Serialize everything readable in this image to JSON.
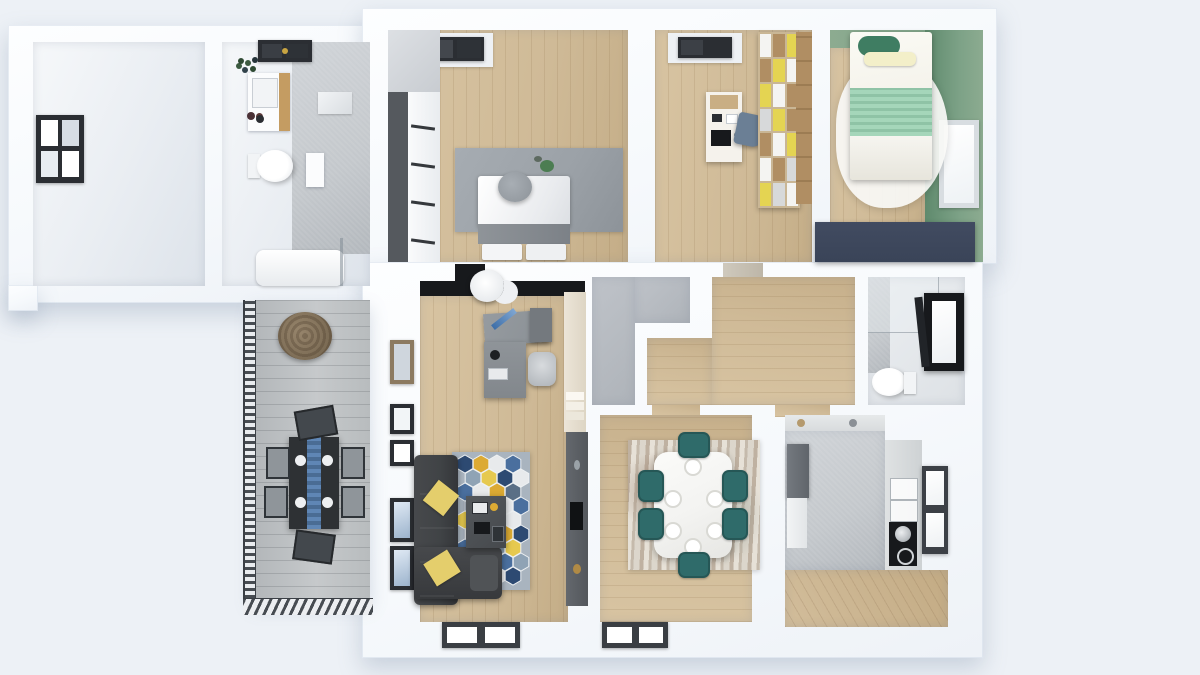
{
  "scene": {
    "name": "apartment-3d-floor-plan-top-view",
    "style": "3d-architectural-render",
    "visible_text": []
  },
  "colors": {
    "bg": "#edf1f6",
    "wood": "#cfba97",
    "wood_line": "rgba(125,95,55,.14)",
    "tile": "#c4c8cc",
    "closet": "#aeb3b9",
    "green_wall": "#7da287",
    "green_deep": "#5f8a6d",
    "mint": "#a5d6ba",
    "navy": "#3a4458",
    "sofa": "#404346",
    "pillow": "#e4ce6c",
    "teal": "#2f6b6a",
    "marble": "#f3f3f1",
    "rug_gray": "#9ba1a7",
    "desk": "#8a9095",
    "black": "#17191c",
    "cream": "#ece5d8",
    "frame": "#2b2e33",
    "hex_navy": "#2d4a72",
    "hex_blue": "#4a6f9e",
    "hex_yellow": "#dcaa33",
    "hex_light": "#e8eaec",
    "cube_yellow": "#e4d452",
    "cube_wood": "#b08e63"
  },
  "rooms": [
    {
      "id": "empty-room",
      "floor": "white",
      "furniture": [
        "left-wall-window"
      ]
    },
    {
      "id": "bathroom-main",
      "floor": "gray-tile",
      "furniture": [
        "skylight-window",
        "plant",
        "wood-vanity",
        "toilet",
        "wall-niche",
        "bathtub",
        "shower-glass"
      ]
    },
    {
      "id": "bedroom-1",
      "floor": "wood",
      "furniture": [
        "skylight-window",
        "wardrobe",
        "gray-rug",
        "double-bed",
        "round-pouf"
      ]
    },
    {
      "id": "study",
      "floor": "wood",
      "furniture": [
        "skylight-window",
        "desk",
        "desk-chair",
        "cube-shelf"
      ]
    },
    {
      "id": "bedroom-2-green",
      "floor": "wood",
      "wall_color": "green",
      "furniture": [
        "double-bed-mint",
        "fluffy-white-rug",
        "navy-wardrobe",
        "right-wall-window"
      ]
    },
    {
      "id": "home-office",
      "floor": "wood",
      "furniture": [
        "black-media-band",
        "ceiling-lamp",
        "gray-desk",
        "office-chair",
        "tall-cream-cabinet",
        "west-windows"
      ]
    },
    {
      "id": "hallway",
      "floor": "wood-and-gray",
      "furniture": [
        "door-thresholds"
      ]
    },
    {
      "id": "bathroom-small",
      "floor": "light",
      "furniture": [
        "shower-glass",
        "toilet",
        "open-black-window"
      ]
    },
    {
      "id": "living-room",
      "floor": "wood",
      "furniture": [
        "corner-sofa",
        "yellow-pillows",
        "hexagon-rug",
        "coffee-table",
        "tv-partition",
        "sliding-window"
      ]
    },
    {
      "id": "dining-room",
      "floor": "wood",
      "furniture": [
        "abstract-rug",
        "marble-dining-table",
        "teal-chairs-x6",
        "sliding-window"
      ]
    },
    {
      "id": "kitchen",
      "floor": "tile-and-wood",
      "furniture": [
        "fridge",
        "left-counter",
        "right-counter",
        "sink",
        "glass-canisters",
        "window"
      ]
    },
    {
      "id": "balcony",
      "floor": "gray-deck",
      "furniture": [
        "metal-railing",
        "rattan-chair",
        "outdoor-dining-table",
        "outdoor-chairs-x6"
      ]
    }
  ]
}
